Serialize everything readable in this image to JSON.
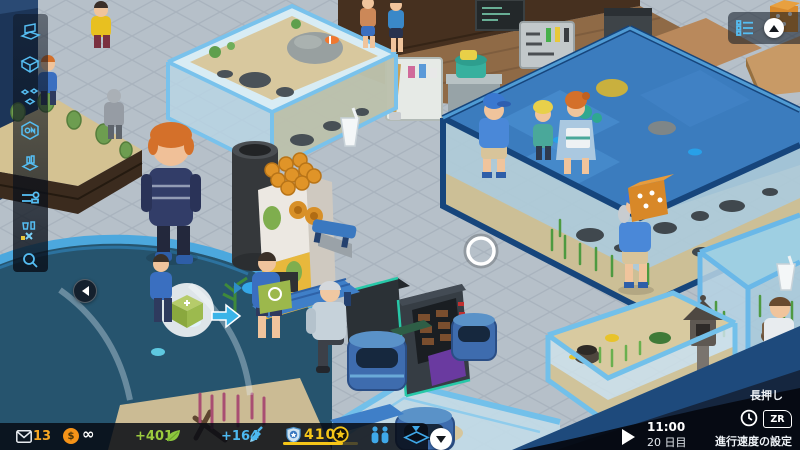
{
  "hud": {
    "mail": {
      "icon": "envelope-icon",
      "count": "13",
      "color": "#f5a623"
    },
    "money": {
      "icon": "dollar-coin-icon",
      "coin_symbol": "$",
      "value": "∞",
      "coin_color": "#f59318"
    },
    "ecology": {
      "icon": "leaf-icon",
      "value": "+401",
      "color": "#9ccc3e"
    },
    "science": {
      "icon": "brush-icon",
      "value": "+164",
      "color": "#4db8f0"
    },
    "prestige": {
      "shield_icon": "shield-icon",
      "value": "410",
      "star_icon": "star-circle-icon",
      "color": "#f5c518",
      "progress_percent": 80
    },
    "visitors_icon": "two-people-icon",
    "view_icon": "diamond-layer-icon",
    "collapse_icon": "chevron-down-icon"
  },
  "sidebar": {
    "icons": [
      {
        "name": "laptop-icon"
      },
      {
        "name": "tank-icon"
      },
      {
        "name": "decorations-icon"
      },
      {
        "name": "chemistry-icon"
      },
      {
        "name": "food-icon"
      },
      {
        "name": "tools-icon"
      },
      {
        "name": "zones-icon"
      },
      {
        "name": "search-icon"
      }
    ],
    "back_icon": "chevron-left-icon"
  },
  "top_right": {
    "menu_icon": "checklist-icon",
    "collapse_icon": "chevron-up-icon"
  },
  "time_panel": {
    "play_icon": "play-icon",
    "time": "11:00",
    "day": "20 日目",
    "hold_hint": "長押し",
    "clock_icon": "clock-icon",
    "button_label": "ZR",
    "speed_label": "進行速度の設定"
  },
  "colors": {
    "accent_blue": "#4db8f0",
    "accent_yellow": "#f5c518",
    "coin_orange": "#f59318",
    "eco_green": "#9ccc3e",
    "hud_bg": "rgba(7,11,19,0.85)",
    "tank_frame": "#6ab8e8",
    "water": "#3b7cbe",
    "floor": "#b6c0c9"
  },
  "scene": {
    "objects": [
      "clownfish-tank",
      "large-reef-tank",
      "lantern-tank",
      "right-plant-tank",
      "curved-tank",
      "bottom-tank",
      "terrarium",
      "juice-machine",
      "vending-machine",
      "trash-bins",
      "benches",
      "staff-room",
      "visitors",
      "staff-carrying-food-box",
      "staff-carrying-plant-box-bubble",
      "drink-thought-icons",
      "cursor-ring"
    ]
  }
}
